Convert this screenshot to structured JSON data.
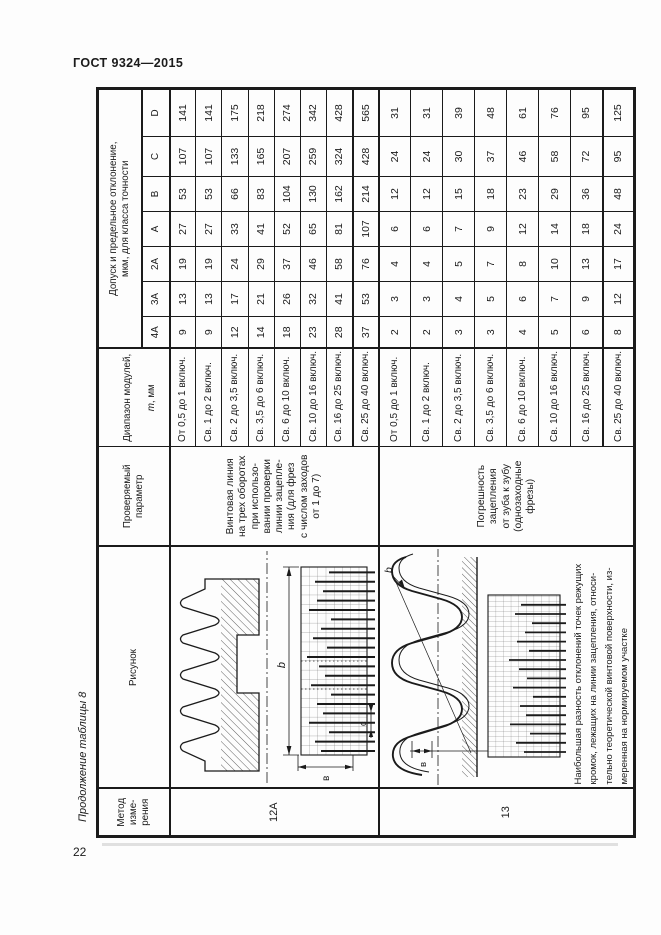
{
  "page": {
    "header": "ГОСТ 9324—2015",
    "margin_note": "Продолжение таблицы 8",
    "page_number": "22"
  },
  "table": {
    "headers": {
      "method": "Метод\nизме-\nрения",
      "figure": "Рисунок",
      "parameter": "Проверяемый\nпараметр",
      "module_range_1": "Диапазон модулей,",
      "module_range_m": "m",
      "module_range_2": ", мм",
      "tolerance": "Допуск и предельное отклонение,\nмкм, для класса точности",
      "accuracy_classes": [
        "4А",
        "3А",
        "2А",
        "А",
        "В",
        "С",
        "D"
      ]
    },
    "blocks": [
      {
        "method": "12А",
        "parameter": "Винтовая линия\nна трех оборотах\nпри использо-\nвании проверки\nлинии зацепле-\nния (для фрез\nс числом заходов\nот 1 до 7)",
        "figure_labels": {
          "b": "b",
          "v": "в",
          "c": "с"
        },
        "rows": [
          {
            "module": "От 0,5 до 1 включ.",
            "values": [
              "9",
              "13",
              "19",
              "27",
              "53",
              "107",
              "141"
            ]
          },
          {
            "module": "Св. 1 до 2 включ.",
            "values": [
              "9",
              "13",
              "19",
              "27",
              "53",
              "107",
              "141"
            ]
          },
          {
            "module": "Св. 2 до 3,5 включ.",
            "values": [
              "12",
              "17",
              "24",
              "33",
              "66",
              "133",
              "175"
            ]
          },
          {
            "module": "Св. 3,5 до 6 включ.",
            "values": [
              "14",
              "21",
              "29",
              "41",
              "83",
              "165",
              "218"
            ]
          },
          {
            "module": "Св. 6 до 10 включ.",
            "values": [
              "18",
              "26",
              "37",
              "52",
              "104",
              "207",
              "274"
            ]
          },
          {
            "module": "Св. 10 до 16 включ.",
            "values": [
              "23",
              "32",
              "46",
              "65",
              "130",
              "259",
              "342"
            ]
          },
          {
            "module": "Св. 16 до 25 включ.",
            "values": [
              "28",
              "41",
              "58",
              "81",
              "162",
              "324",
              "428"
            ]
          },
          {
            "module": "Св. 25 до 40 включ.",
            "values": [
              "37",
              "53",
              "76",
              "107",
              "214",
              "428",
              "565"
            ]
          }
        ]
      },
      {
        "method": "13",
        "parameter": "Погрешность\nзацепления\nот зуба к зубу\n(однозаходные\nфрезы)",
        "figure_labels": {
          "b": "b",
          "v": "в"
        },
        "note": "Наибольшая разность отклонений точек режущих\nкромок, лежащих на линии зацепления, относи-\nтельно теоретической винтовой поверхности, из-\nмеренная на нормируемом участке",
        "rows": [
          {
            "module": "От 0,5 до 1 включ.",
            "values": [
              "2",
              "3",
              "4",
              "6",
              "12",
              "24",
              "31"
            ]
          },
          {
            "module": "Св. 1 до 2 включ.",
            "values": [
              "2",
              "3",
              "4",
              "6",
              "12",
              "24",
              "31"
            ]
          },
          {
            "module": "Св. 2 до 3,5 включ.",
            "values": [
              "3",
              "4",
              "5",
              "7",
              "15",
              "30",
              "39"
            ]
          },
          {
            "module": "Св. 3,5 до 6 включ.",
            "values": [
              "3",
              "5",
              "7",
              "9",
              "18",
              "37",
              "48"
            ]
          },
          {
            "module": "Св. 6 до 10 включ.",
            "values": [
              "4",
              "6",
              "8",
              "12",
              "23",
              "46",
              "61"
            ]
          },
          {
            "module": "Св. 10 до 16 включ.",
            "values": [
              "5",
              "7",
              "10",
              "14",
              "29",
              "58",
              "76"
            ]
          },
          {
            "module": "Св. 16 до 25 включ.",
            "values": [
              "6",
              "9",
              "13",
              "18",
              "36",
              "72",
              "95"
            ]
          },
          {
            "module": "Св. 25 до 40 включ.",
            "values": [
              "8",
              "12",
              "17",
              "24",
              "48",
              "95",
              "125"
            ]
          }
        ]
      }
    ]
  }
}
